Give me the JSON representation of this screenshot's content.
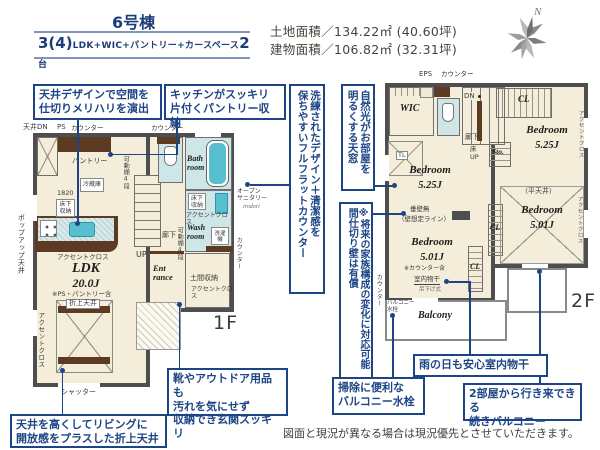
{
  "header": {
    "building": "6号棟",
    "plan_num": "3(4)",
    "plan_detail": "LDK+WIC+パントリー+カースペース",
    "plan_count": "2",
    "plan_count_unit": "台",
    "land_area": "土地面積／134.22㎡ (40.60坪)",
    "building_area": "建物面積／106.82㎡ (32.31坪)",
    "compass_n": "N"
  },
  "callouts": {
    "ceiling_design": "天井デザインで空間を\n仕切りメリハリを演出",
    "pantry_storage": "キッチンがスッキリ\n片付くパントリー収納",
    "flat_counter": "洗練されたデザイン＋清潔感を\n保ちやすいフルフラットカウンター",
    "skylight": "自然光がお部屋を\n明るくする天窓",
    "partition_free": "※将来の家族構成の変化に対応可能\n間仕切り壁は有償",
    "entrance_storage": "靴やアウトドア用品も\n汚れを気にせず\n収納でき玄関スッキリ",
    "coffered_ceiling": "天井を高くしてリビングに\n開放感をプラスした折上天井",
    "balcony_faucet": "掃除に便利な\nバルコニー水栓",
    "indoor_drying": "雨の日も安心室内物干",
    "continuous_balcony": "2部屋から行き来できる\n続きバルコニー"
  },
  "common": {
    "accent_cloth": "アクセントクロス",
    "counter": "カウンター",
    "closet": "CL",
    "underfloor_storage": "床下\n収納",
    "movable_shelf": "可動棚4段",
    "bedroom": "Bedroom"
  },
  "floor1": {
    "floor_label": "1F",
    "ceiling_dn": "天井DN",
    "ps": "PS",
    "pantry": "パントリー",
    "fridge": "冷蔵庫",
    "dim_1820": "1820",
    "popup_ceiling": "ポップアップ天井",
    "ldk": "LDK",
    "ldk_size": "20.0J",
    "ldk_note": "※PS・パントリー含",
    "coffered_label": "折上天井",
    "shutter": "シャッター",
    "up": "UP",
    "hallway": "廊下",
    "bath": "Bath\nroom",
    "wash": "Wash\nroom",
    "washer": "洗濯機",
    "open_sanitary": "オープン\nサニタリー",
    "sanitary_brand": "irodori",
    "entrance": "Ent\nrance",
    "doma_storage": "土間収納"
  },
  "floor2": {
    "floor_label": "2F",
    "eps": "EPS",
    "wic": "WIC",
    "dn": "DN",
    "hallway": "廊下",
    "floor_up": "床\nUP",
    "storage": "Sto.",
    "skylight_tl": "TL",
    "bed_525": "5.25J",
    "bed_501": "5.01J",
    "bed3_note": "※カウンター含",
    "flat_ceiling": "（平天井）",
    "no_hanging_wall": "垂壁無",
    "assumed_wall": "（壁想定ライン）",
    "indoor_dry": "室内物干",
    "dry_type": "吊下げ式",
    "balcony_faucet": "バルコニー\n水栓",
    "balcony": "Balcony"
  },
  "disclaimer": "図面と現況が異なる場合は現況優先とさせていただきます。"
}
